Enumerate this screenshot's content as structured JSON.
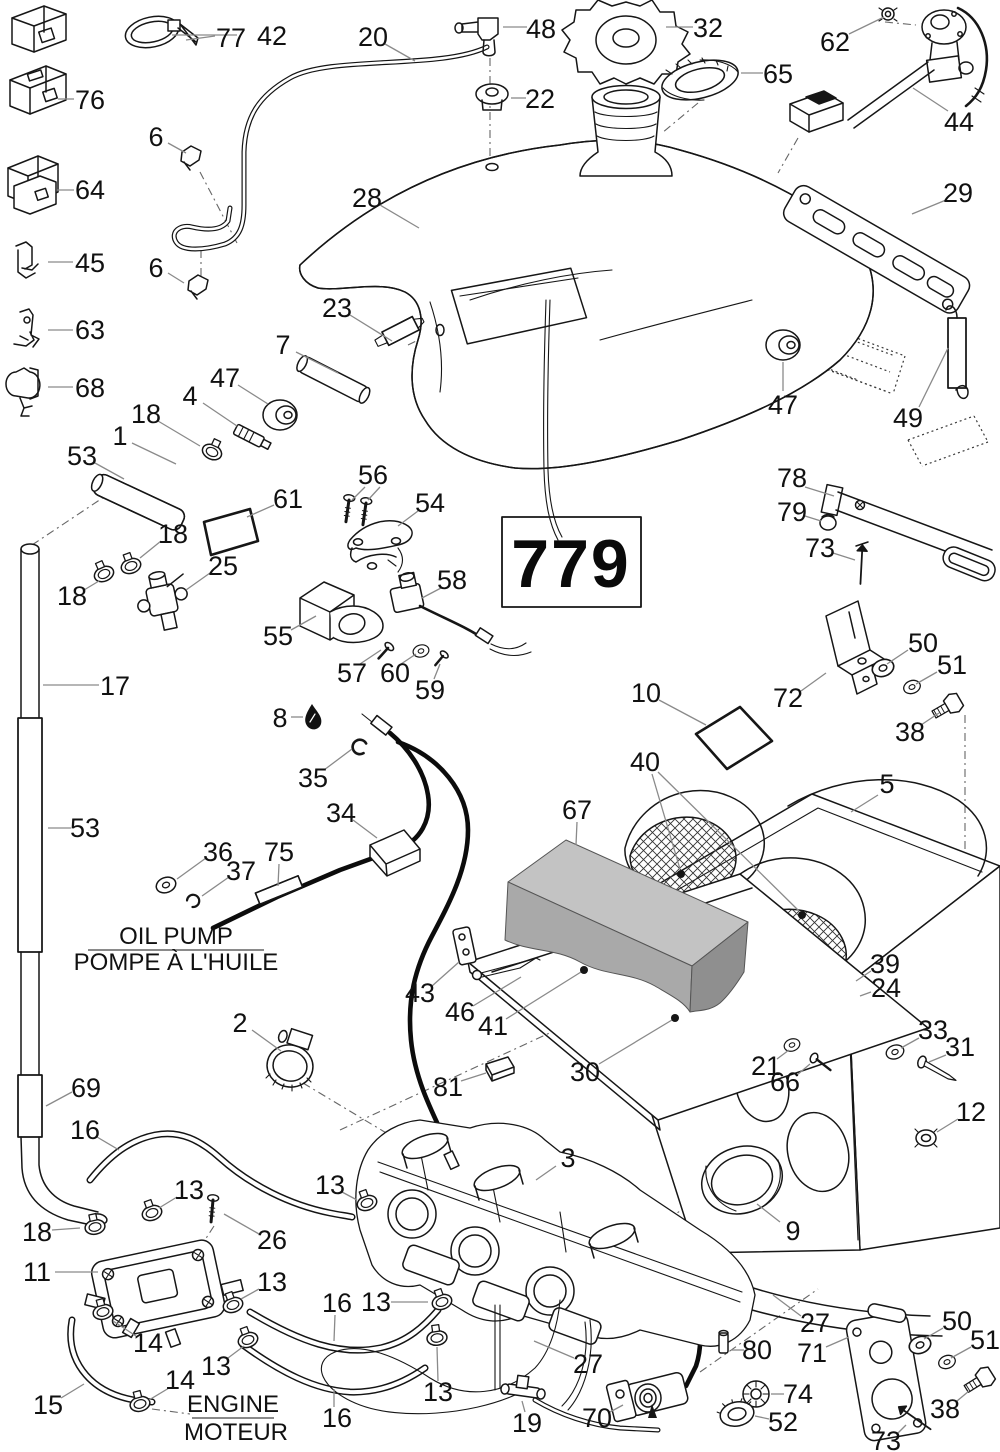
{
  "code_box": {
    "label": "779"
  },
  "texts": {
    "oil_pump_en": "OIL PUMP",
    "oil_pump_fr": "POMPE À L'HUILE",
    "engine_en": "ENGINE",
    "engine_fr": "MOTEUR"
  },
  "colors": {
    "ink": "#161616",
    "leader": "#8a8a8a",
    "foam": "#b4b4b4"
  },
  "callouts": [
    {
      "t": "42",
      "x": 272,
      "y": 36,
      "l": [
        237,
        35,
        172,
        35
      ]
    },
    {
      "t": "77",
      "x": 231,
      "y": 38,
      "l": [
        215,
        36,
        186,
        40
      ]
    },
    {
      "t": "76",
      "x": 90,
      "y": 100,
      "l": [
        74,
        99,
        58,
        99
      ]
    },
    {
      "t": "6",
      "x": 156,
      "y": 137,
      "l": [
        168,
        143,
        186,
        153
      ]
    },
    {
      "t": "64",
      "x": 90,
      "y": 190,
      "l": [
        74,
        190,
        57,
        190
      ]
    },
    {
      "t": "45",
      "x": 90,
      "y": 263,
      "l": [
        73,
        262,
        48,
        262
      ]
    },
    {
      "t": "63",
      "x": 90,
      "y": 330,
      "l": [
        73,
        330,
        48,
        330
      ]
    },
    {
      "t": "68",
      "x": 90,
      "y": 388,
      "l": [
        73,
        387,
        48,
        387
      ]
    },
    {
      "t": "6",
      "x": 156,
      "y": 268,
      "l": [
        168,
        273,
        184,
        283
      ]
    },
    {
      "t": "20",
      "x": 373,
      "y": 37,
      "l": [
        385,
        44,
        415,
        61
      ]
    },
    {
      "t": "48",
      "x": 541,
      "y": 29,
      "l": [
        527,
        27,
        503,
        27
      ]
    },
    {
      "t": "22",
      "x": 540,
      "y": 99,
      "l": [
        526,
        98,
        511,
        98
      ]
    },
    {
      "t": "32",
      "x": 708,
      "y": 28,
      "l": [
        693,
        27,
        666,
        27
      ]
    },
    {
      "t": "65",
      "x": 778,
      "y": 74,
      "l": [
        763,
        73,
        741,
        73
      ]
    },
    {
      "t": "28",
      "x": 367,
      "y": 198,
      "l": [
        380,
        205,
        419,
        228
      ]
    },
    {
      "t": "62",
      "x": 835,
      "y": 42,
      "l": [
        849,
        34,
        884,
        17
      ]
    },
    {
      "t": "44",
      "x": 959,
      "y": 122,
      "l": [
        948,
        111,
        913,
        88
      ]
    },
    {
      "t": "29",
      "x": 958,
      "y": 193,
      "l": [
        946,
        200,
        912,
        214
      ]
    },
    {
      "t": "23",
      "x": 337,
      "y": 308,
      "l": [
        350,
        315,
        392,
        341
      ]
    },
    {
      "t": "7",
      "x": 283,
      "y": 345,
      "l": [
        296,
        352,
        338,
        373
      ]
    },
    {
      "t": "47",
      "x": 225,
      "y": 378,
      "l": [
        238,
        385,
        268,
        404
      ]
    },
    {
      "t": "4",
      "x": 190,
      "y": 396,
      "l": [
        203,
        403,
        237,
        426
      ]
    },
    {
      "t": "18",
      "x": 146,
      "y": 414,
      "l": [
        158,
        421,
        200,
        446
      ]
    },
    {
      "t": "1",
      "x": 120,
      "y": 436,
      "l": [
        132,
        443,
        176,
        464
      ]
    },
    {
      "t": "53",
      "x": 82,
      "y": 456,
      "l": [
        95,
        463,
        124,
        479
      ]
    },
    {
      "t": "61",
      "x": 288,
      "y": 499,
      "l": [
        274,
        505,
        247,
        517
      ]
    },
    {
      "t": "18",
      "x": 173,
      "y": 534,
      "l": [
        161,
        541,
        140,
        558
      ]
    },
    {
      "t": "25",
      "x": 223,
      "y": 566,
      "l": [
        210,
        573,
        186,
        590
      ]
    },
    {
      "t": "18",
      "x": 72,
      "y": 596,
      "l": [
        84,
        590,
        99,
        581
      ]
    },
    {
      "t": "17",
      "x": 115,
      "y": 686,
      "l": [
        99,
        685,
        43,
        685
      ]
    },
    {
      "t": "53",
      "x": 85,
      "y": 828,
      "l": [
        71,
        828,
        48,
        828
      ]
    },
    {
      "t": "56",
      "x": 373,
      "y": 475,
      "l": [
        365,
        487,
        352,
        500
      ],
      "l2": [
        380,
        487,
        368,
        500
      ]
    },
    {
      "t": "54",
      "x": 430,
      "y": 503,
      "l": [
        418,
        511,
        398,
        526
      ]
    },
    {
      "t": "58",
      "x": 452,
      "y": 580,
      "l": [
        441,
        588,
        422,
        598
      ]
    },
    {
      "t": "55",
      "x": 278,
      "y": 636,
      "l": [
        291,
        630,
        316,
        616
      ]
    },
    {
      "t": "57",
      "x": 352,
      "y": 673,
      "l": [
        360,
        664,
        381,
        650
      ]
    },
    {
      "t": "60",
      "x": 395,
      "y": 673,
      "l": [
        401,
        664,
        416,
        654
      ]
    },
    {
      "t": "59",
      "x": 430,
      "y": 690,
      "l": [
        434,
        679,
        440,
        664
      ]
    },
    {
      "t": "8",
      "x": 280,
      "y": 718,
      "l": [
        291,
        717,
        303,
        717
      ]
    },
    {
      "t": "35",
      "x": 313,
      "y": 778,
      "l": [
        324,
        770,
        352,
        749
      ]
    },
    {
      "t": "34",
      "x": 341,
      "y": 813,
      "l": [
        353,
        820,
        377,
        838
      ]
    },
    {
      "t": "36",
      "x": 218,
      "y": 852,
      "l": [
        206,
        858,
        177,
        879
      ]
    },
    {
      "t": "37",
      "x": 241,
      "y": 871,
      "l": [
        229,
        877,
        202,
        896
      ]
    },
    {
      "t": "75",
      "x": 279,
      "y": 852,
      "l": [
        279,
        864,
        278,
        886
      ]
    },
    {
      "t": "69",
      "x": 86,
      "y": 1088,
      "l": [
        72,
        1092,
        46,
        1106
      ]
    },
    {
      "t": "16",
      "x": 85,
      "y": 1130,
      "l": [
        97,
        1137,
        119,
        1150
      ]
    },
    {
      "t": "2",
      "x": 240,
      "y": 1023,
      "l": [
        252,
        1030,
        281,
        1051
      ]
    },
    {
      "t": "13",
      "x": 189,
      "y": 1190,
      "l": [
        177,
        1197,
        159,
        1208
      ]
    },
    {
      "t": "26",
      "x": 272,
      "y": 1240,
      "l": [
        259,
        1234,
        224,
        1214
      ]
    },
    {
      "t": "13",
      "x": 330,
      "y": 1185,
      "l": [
        342,
        1192,
        357,
        1200
      ]
    },
    {
      "t": "18",
      "x": 37,
      "y": 1232,
      "l": [
        52,
        1230,
        80,
        1228
      ]
    },
    {
      "t": "11",
      "x": 37,
      "y": 1272,
      "l": [
        55,
        1272,
        98,
        1272
      ]
    },
    {
      "t": "13",
      "x": 272,
      "y": 1282,
      "l": [
        259,
        1289,
        241,
        1299
      ]
    },
    {
      "t": "14",
      "x": 148,
      "y": 1343,
      "l": [
        136,
        1336,
        113,
        1321
      ]
    },
    {
      "t": "13",
      "x": 216,
      "y": 1366,
      "l": [
        228,
        1358,
        244,
        1346
      ]
    },
    {
      "t": "15",
      "x": 48,
      "y": 1405,
      "l": [
        61,
        1398,
        84,
        1384
      ]
    },
    {
      "t": "14",
      "x": 180,
      "y": 1380,
      "l": [
        169,
        1388,
        149,
        1400
      ]
    },
    {
      "t": "16",
      "x": 337,
      "y": 1303,
      "l": [
        335,
        1315,
        334,
        1341
      ]
    },
    {
      "t": "16",
      "x": 337,
      "y": 1418,
      "l": [
        334,
        1407,
        334,
        1389
      ]
    },
    {
      "t": "3",
      "x": 568,
      "y": 1158,
      "l": [
        556,
        1166,
        536,
        1180
      ]
    },
    {
      "t": "13",
      "x": 376,
      "y": 1302,
      "l": [
        391,
        1302,
        428,
        1302
      ]
    },
    {
      "t": "13",
      "x": 438,
      "y": 1392,
      "l": [
        438,
        1381,
        437,
        1347
      ]
    },
    {
      "t": "27",
      "x": 588,
      "y": 1364,
      "l": [
        574,
        1358,
        534,
        1341
      ]
    },
    {
      "t": "19",
      "x": 527,
      "y": 1423,
      "l": [
        525,
        1412,
        522,
        1401
      ]
    },
    {
      "t": "70",
      "x": 597,
      "y": 1418,
      "l": [
        610,
        1412,
        623,
        1405
      ]
    },
    {
      "t": "39",
      "x": 885,
      "y": 964,
      "l": [
        871,
        971,
        856,
        981
      ]
    },
    {
      "t": "24",
      "x": 886,
      "y": 988,
      "l": [
        871,
        992,
        860,
        996
      ]
    },
    {
      "t": "33",
      "x": 933,
      "y": 1030,
      "l": [
        919,
        1038,
        901,
        1048
      ]
    },
    {
      "t": "31",
      "x": 960,
      "y": 1047,
      "l": [
        946,
        1055,
        929,
        1062
      ]
    },
    {
      "t": "21",
      "x": 766,
      "y": 1066,
      "l": [
        777,
        1059,
        789,
        1050
      ]
    },
    {
      "t": "66",
      "x": 785,
      "y": 1082,
      "l": [
        797,
        1075,
        810,
        1064
      ]
    },
    {
      "t": "12",
      "x": 971,
      "y": 1112,
      "l": [
        958,
        1119,
        937,
        1132
      ]
    },
    {
      "t": "9",
      "x": 793,
      "y": 1231,
      "l": [
        780,
        1222,
        757,
        1204
      ]
    },
    {
      "t": "5",
      "x": 887,
      "y": 784,
      "l": [
        878,
        795,
        851,
        812
      ]
    },
    {
      "t": "40",
      "x": 645,
      "y": 762,
      "l": [
        652,
        774,
        680,
        869
      ],
      "l2": [
        658,
        772,
        799,
        911
      ],
      "dots": [
        [
          681,
          874
        ],
        [
          802,
          915
        ]
      ]
    },
    {
      "t": "10",
      "x": 646,
      "y": 693,
      "l": [
        659,
        700,
        706,
        725
      ]
    },
    {
      "t": "72",
      "x": 788,
      "y": 698,
      "l": [
        801,
        691,
        826,
        673
      ]
    },
    {
      "t": "50",
      "x": 923,
      "y": 643,
      "l": [
        908,
        650,
        887,
        664
      ]
    },
    {
      "t": "51",
      "x": 952,
      "y": 665,
      "l": [
        937,
        672,
        916,
        684
      ]
    },
    {
      "t": "38",
      "x": 910,
      "y": 732,
      "l": [
        921,
        725,
        939,
        713
      ]
    },
    {
      "t": "67",
      "x": 577,
      "y": 810,
      "l": [
        577,
        822,
        576,
        845
      ]
    },
    {
      "t": "43",
      "x": 420,
      "y": 993,
      "l": [
        432,
        986,
        459,
        962
      ]
    },
    {
      "t": "46",
      "x": 460,
      "y": 1012,
      "l": [
        473,
        1006,
        521,
        977
      ]
    },
    {
      "t": "41",
      "x": 493,
      "y": 1026,
      "l": [
        506,
        1019,
        581,
        972
      ],
      "dots": [
        [
          584,
          970
        ]
      ]
    },
    {
      "t": "30",
      "x": 585,
      "y": 1072,
      "l": [
        599,
        1064,
        672,
        1020
      ],
      "dots": [
        [
          675,
          1018
        ]
      ]
    },
    {
      "t": "81",
      "x": 448,
      "y": 1087,
      "l": [
        461,
        1081,
        486,
        1073
      ]
    },
    {
      "t": "27",
      "x": 815,
      "y": 1323,
      "l": [
        801,
        1316,
        773,
        1295
      ]
    },
    {
      "t": "80",
      "x": 757,
      "y": 1350,
      "l": [
        744,
        1350,
        731,
        1350
      ]
    },
    {
      "t": "71",
      "x": 812,
      "y": 1353,
      "l": [
        826,
        1347,
        849,
        1337
      ]
    },
    {
      "t": "74",
      "x": 798,
      "y": 1394,
      "l": [
        784,
        1394,
        771,
        1394
      ]
    },
    {
      "t": "52",
      "x": 783,
      "y": 1422,
      "l": [
        769,
        1419,
        755,
        1416
      ]
    },
    {
      "t": "50",
      "x": 957,
      "y": 1321,
      "l": [
        943,
        1328,
        924,
        1339
      ]
    },
    {
      "t": "51",
      "x": 985,
      "y": 1340,
      "l": [
        971,
        1347,
        951,
        1358
      ]
    },
    {
      "t": "38",
      "x": 945,
      "y": 1409,
      "l": [
        957,
        1401,
        969,
        1391
      ]
    },
    {
      "t": "73",
      "x": 886,
      "y": 1441,
      "l": [
        897,
        1434,
        906,
        1425
      ]
    },
    {
      "t": "49",
      "x": 908,
      "y": 418,
      "l": [
        919,
        407,
        948,
        348
      ]
    },
    {
      "t": "47",
      "x": 783,
      "y": 405,
      "l": [
        783,
        391,
        783,
        362
      ]
    },
    {
      "t": "78",
      "x": 792,
      "y": 478,
      "l": [
        805,
        487,
        834,
        496
      ]
    },
    {
      "t": "79",
      "x": 792,
      "y": 512,
      "l": [
        805,
        516,
        821,
        521
      ]
    },
    {
      "t": "73",
      "x": 820,
      "y": 548,
      "l": [
        833,
        553,
        855,
        560
      ]
    }
  ]
}
